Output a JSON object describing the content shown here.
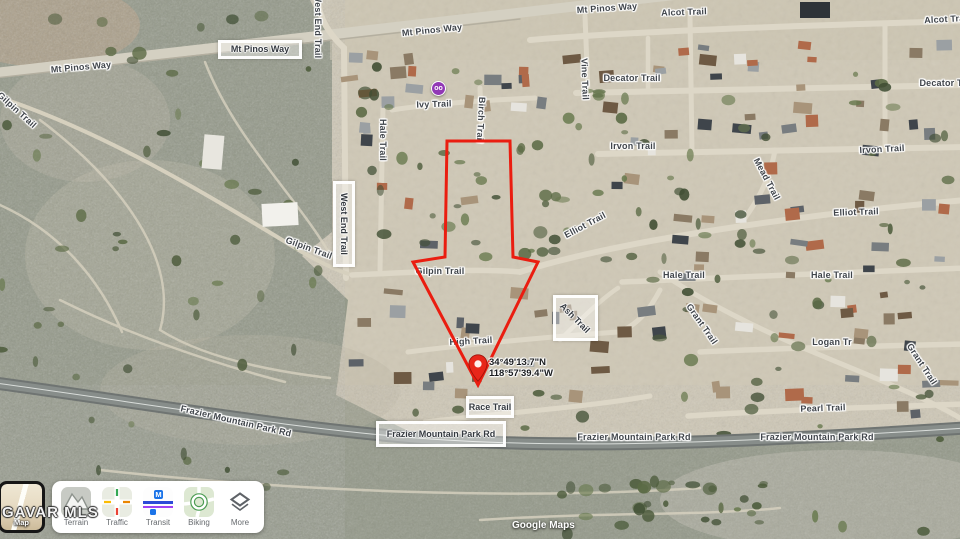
{
  "map_labels": [
    {
      "text": "Mt Pinos Way",
      "x": 81,
      "y": 67,
      "rot": -5
    },
    {
      "text": "Mt Pinos Way",
      "x": 432,
      "y": 30,
      "rot": -6
    },
    {
      "text": "Mt Pinos Way",
      "x": 607,
      "y": 8,
      "rot": -4
    },
    {
      "text": "Alcot Trail",
      "x": 684,
      "y": 12,
      "rot": -2
    },
    {
      "text": "Alcot Trail",
      "x": 947,
      "y": 19,
      "rot": -3
    },
    {
      "text": "Decator Trail",
      "x": 632,
      "y": 78,
      "rot": 0
    },
    {
      "text": "Decator Trail",
      "x": 948,
      "y": 83,
      "rot": 0
    },
    {
      "text": "Vine Trail",
      "x": 585,
      "y": 79,
      "rot": 88
    },
    {
      "text": "West End Trail",
      "x": 318,
      "y": 26,
      "rot": 90
    },
    {
      "text": "Ivy Trail",
      "x": 434,
      "y": 104,
      "rot": -2
    },
    {
      "text": "Birch Trail",
      "x": 481,
      "y": 120,
      "rot": 93
    },
    {
      "text": "Hale Trail",
      "x": 383,
      "y": 140,
      "rot": 90
    },
    {
      "text": "Irvon Trail",
      "x": 633,
      "y": 146,
      "rot": 0
    },
    {
      "text": "Irvon Trail",
      "x": 882,
      "y": 149,
      "rot": -3
    },
    {
      "text": "Mead Trail",
      "x": 767,
      "y": 179,
      "rot": 62
    },
    {
      "text": "Elliot Trail",
      "x": 585,
      "y": 225,
      "rot": -28
    },
    {
      "text": "Elliot Trail",
      "x": 856,
      "y": 212,
      "rot": -2
    },
    {
      "text": "Hale Trail",
      "x": 684,
      "y": 275,
      "rot": 0
    },
    {
      "text": "Hale Trail",
      "x": 832,
      "y": 275,
      "rot": 0
    },
    {
      "text": "Gilpin Trail",
      "x": 17,
      "y": 110,
      "rot": 42
    },
    {
      "text": "Gilpin Trail",
      "x": 309,
      "y": 248,
      "rot": 20
    },
    {
      "text": "Gilpin Trail",
      "x": 440,
      "y": 271,
      "rot": 0
    },
    {
      "text": "High Trail",
      "x": 471,
      "y": 341,
      "rot": -3
    },
    {
      "text": "Grant Trail",
      "x": 702,
      "y": 324,
      "rot": 55
    },
    {
      "text": "Grant Trail",
      "x": 922,
      "y": 364,
      "rot": 57
    },
    {
      "text": "Logan Tr",
      "x": 832,
      "y": 342,
      "rot": 0
    },
    {
      "text": "Pearl Trail",
      "x": 823,
      "y": 408,
      "rot": -2
    },
    {
      "text": "Frazier Mountain Park Rd",
      "x": 236,
      "y": 421,
      "rot": 13
    },
    {
      "text": "Frazier Mountain Park Rd",
      "x": 634,
      "y": 437,
      "rot": 0
    },
    {
      "text": "Frazier Mountain Park Rd",
      "x": 817,
      "y": 437,
      "rot": 0
    }
  ],
  "boxed_labels": [
    {
      "text": "Mt Pinos Way",
      "x": 260,
      "y": 49,
      "w": 84,
      "h": 19
    },
    {
      "text": "West End Trail",
      "x": 344,
      "y": 224,
      "w": 22,
      "h": 86,
      "vertical": true
    },
    {
      "text": "Ash Trail",
      "x": 575,
      "y": 318,
      "w": 45,
      "h": 46,
      "rot": 45
    },
    {
      "text": "Race Trail",
      "x": 490,
      "y": 407,
      "w": 48,
      "h": 22
    },
    {
      "text": "Frazier Mountain Park Rd",
      "x": 441,
      "y": 434,
      "w": 130,
      "h": 26
    }
  ],
  "parcel": {
    "polygon": [
      [
        447,
        141
      ],
      [
        510,
        141
      ],
      [
        513,
        257
      ],
      [
        538,
        262
      ],
      [
        478,
        385
      ],
      [
        413,
        262
      ],
      [
        445,
        257
      ]
    ],
    "outline_color": "#ea1d10",
    "pin_x": 478,
    "pin_y": 385,
    "pin_color": "#e8261a",
    "coords_line1": "34°49'13.7\"N",
    "coords_line2": "118°57'39.4\"W"
  },
  "poi": {
    "icon": "purple-place-marker",
    "glyph": "oo",
    "color": "#9138b5"
  },
  "watermark": "GAVAR MLS",
  "attribution": "Google Maps",
  "controls": {
    "map_label": "Map",
    "items": [
      {
        "label": "Terrain"
      },
      {
        "label": "Traffic"
      },
      {
        "label": "Transit"
      },
      {
        "label": "Biking"
      },
      {
        "label": "More"
      }
    ]
  },
  "colors": {
    "scrub": "#959a8e",
    "neighborhood": "#cfc8b6",
    "road": "#ddd7c7",
    "highway": "#6f7472",
    "parcel_red": "#ea1d10"
  }
}
